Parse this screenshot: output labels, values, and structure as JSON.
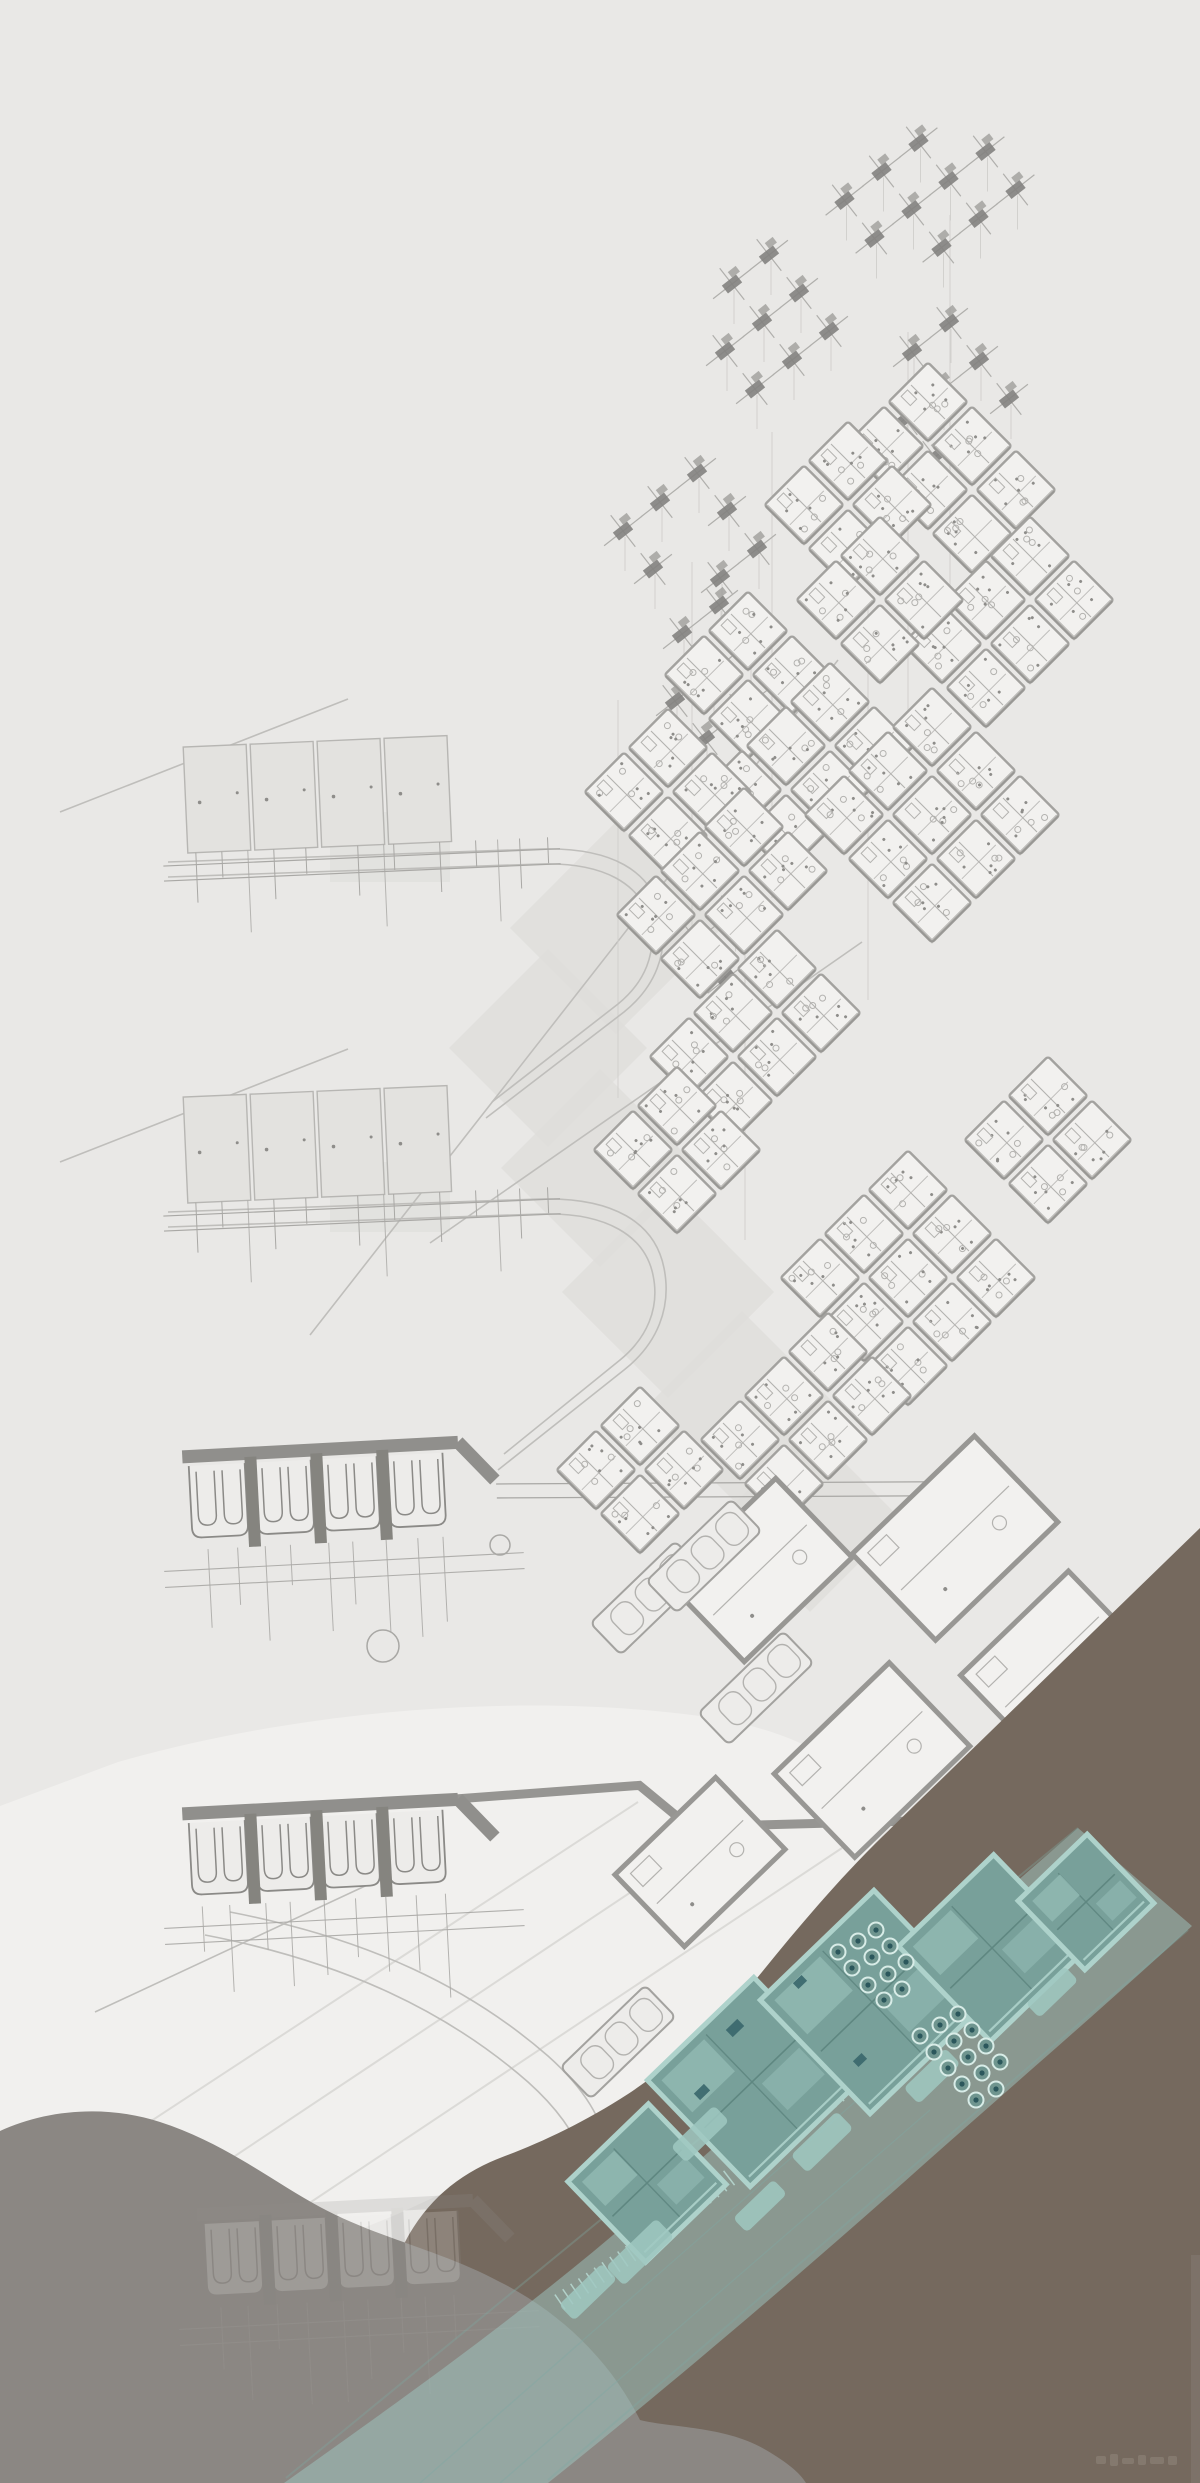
{
  "canvas": {
    "width": 1200,
    "height": 2483,
    "background": "#e9e8e6"
  },
  "palette": {
    "line_faint": "#d0cfcc",
    "line_road": "#bfbebb",
    "line_mid": "#a9a8a5",
    "panel_fill": "#e3e2df",
    "panel_stroke": "#b7b6b3",
    "tile_fill": "#f2f1ef",
    "tile_stroke": "#a3a29f",
    "tile_shadow": "#8f8e8b",
    "tile_detail": "#b3b2af",
    "tile_dot": "#8e8d8a",
    "desk_dark": "#83827f",
    "desk_mid": "#9a9996",
    "desk_leg": "#b0afac",
    "arch_bar": "#908f8c",
    "arch_line": "#8b8a87",
    "arch_fill": "#edecea",
    "arch_pillar": "#85847f",
    "patch": "#dedddb",
    "white_sheet": "#f1f0ee",
    "fold": "#dbdad7",
    "terrain_brown": "#75695e",
    "terrain_mound": "#8b8783",
    "edge_strip": "#80766d",
    "teal_band": "#9fc8c1",
    "teal_band_edge": "#7fa8a2",
    "teal_floor": "#78a09a",
    "teal_wall": "#aed2cb",
    "teal_room": "#8fb7b0",
    "teal_line": "#5f8781",
    "teal_hatch": "#b9dbd4",
    "teal_dark": "#38666b",
    "tree_ring": "#d8ece7",
    "tree_fill": "#6f958f",
    "tree_dot": "#2b575c",
    "loose_wall": "#989794",
    "watermark": "#93897f"
  },
  "terrain": {
    "white_sheet_path": "M 118 1762 C 300 1710 520 1692 700 1716 C 802 1730 864 1770 882 1822 C 866 1874 830 1926 780 1976 C 730 2026 668 2073 600 2113 C 540 2147 470 2181 400 2213 C 330 2243 250 2269 180 2273 C 118 2276 68 2256 38 2230 L 0 2208 L 0 1806 Z",
    "brown_path": "M 1200 1528 L 883 1836 C 840 1878 800 1925 762 1972 C 724 2019 676 2062 628 2094 C 585 2122 540 2143 505 2156 C 462 2172 428 2198 405 2242 C 388 2275 378 2320 374 2365 L 370 2483 L 1200 2483 Z",
    "mound_path": "M 0 2131 C 45 2110 105 2104 160 2122 C 225 2143 270 2180 320 2207 C 380 2239 440 2250 500 2282 C 560 2312 610 2360 640 2420 C 672 2428 726 2426 766 2450 C 788 2463 800 2473 806 2483 L 0 2483 Z",
    "edge_strip": [
      1191,
      2255,
      9,
      228
    ]
  },
  "fold_lines": [
    [
      242,
      2248,
      842,
      1848
    ],
    [
      142,
      2218,
      742,
      1818
    ],
    [
      58,
      2182,
      638,
      1802
    ]
  ],
  "diagonals": [
    [
      310,
      1335,
      838,
      660
    ],
    [
      430,
      1243,
      862,
      942
    ],
    [
      60,
      812,
      348,
      699
    ],
    [
      60,
      1162,
      348,
      1049
    ],
    [
      95,
      2012,
      378,
      1880
    ]
  ],
  "verticals": [
    [
      772,
      432,
      898
    ],
    [
      908,
      332,
      792
    ],
    [
      950,
      215,
      602
    ],
    [
      692,
      562,
      942
    ],
    [
      618,
      700,
      1098
    ],
    [
      868,
      598,
      1000
    ],
    [
      745,
      880,
      1240
    ]
  ],
  "roads": [
    "M 168 862 L 540 849 C 612 847 652 871 661 915 C 669 953 655 987 624 1012 L 486 1118",
    "M 168 877 L 540 864 C 604 862 641 884 650 921 C 657 953 645 982 618 1004 L 492 1102",
    "M 168 1212 L 540 1199 C 614 1197 655 1223 664 1268 C 672 1308 657 1344 624 1370 L 498 1470",
    "M 168 1227 L 540 1214 C 607 1212 645 1236 653 1275 C 660 1308 647 1338 620 1360 L 504 1454",
    "M 205 1935 C 345 1962 448 2012 528 2082 C 566 2116 585 2149 590 2182",
    "M 230 1912 C 370 1939 470 1988 548 2056 C 585 2089 603 2120 608 2152"
  ],
  "patches": [
    [
      616,
      928,
      150
    ],
    [
      548,
      1048,
      140
    ],
    [
      600,
      1168,
      140
    ],
    [
      668,
      1292,
      150
    ],
    [
      742,
      1410,
      140
    ],
    [
      810,
      1520,
      130
    ]
  ],
  "patch_rects": [
    [
      330,
      812,
      120,
      70
    ],
    [
      330,
      1162,
      120,
      70
    ]
  ],
  "panel_rows": [
    [
      188,
      747
    ],
    [
      188,
      1097
    ]
  ],
  "arch_rows": [
    {
      "x": 190,
      "y": 1450,
      "ext": "short"
    },
    {
      "x": 190,
      "y": 1807,
      "ext": "long"
    }
  ],
  "ghost_row": {
    "x": 205,
    "y": 2208,
    "opacity": 0.2
  },
  "desk_clusters": [
    [
      930,
      195,
      4,
      3
    ],
    [
      762,
      322,
      3,
      3
    ],
    [
      942,
      390,
      3,
      3
    ],
    [
      690,
      540,
      3,
      3
    ],
    [
      712,
      672,
      3,
      3
    ],
    [
      730,
      945,
      2,
      2
    ]
  ],
  "plan_clusters": [
    [
      950,
      468,
      2,
      3
    ],
    [
      848,
      505,
      2,
      2
    ],
    [
      1008,
      622,
      3,
      2
    ],
    [
      880,
      600,
      2,
      2
    ],
    [
      748,
      675,
      2,
      2
    ],
    [
      808,
      768,
      3,
      2
    ],
    [
      932,
      815,
      3,
      3
    ],
    [
      668,
      792,
      2,
      2
    ],
    [
      722,
      893,
      3,
      2
    ],
    [
      755,
      1035,
      3,
      2
    ],
    [
      677,
      1150,
      2,
      2
    ],
    [
      1048,
      1140,
      2,
      2
    ],
    [
      908,
      1278,
      3,
      3
    ],
    [
      806,
      1418,
      3,
      2
    ],
    [
      640,
      1470,
      2,
      2
    ]
  ],
  "loose_rooms": [
    [
      760,
      1570,
      150,
      110
    ],
    [
      955,
      1538,
      170,
      120
    ],
    [
      1052,
      1662,
      150,
      108
    ],
    [
      872,
      1760,
      160,
      116
    ],
    [
      700,
      1862,
      140,
      100
    ],
    [
      1002,
      1856,
      150,
      108
    ]
  ],
  "parking_strips": [
    [
      648,
      1598
    ],
    [
      704,
      1556
    ],
    [
      756,
      1688
    ],
    [
      618,
      2042
    ]
  ],
  "junction_circles": [
    [
      383,
      1646,
      16
    ],
    [
      500,
      1545,
      10
    ]
  ],
  "teal": {
    "band_path": "M 1078 1828 C 938 1950 778 2092 640 2212 C 520 2316 398 2402 284 2483 L 548 2483 C 662 2392 792 2282 922 2166 C 1012 2086 1112 2000 1192 1926 Z",
    "band_edges": [
      [
        1078,
        1828,
        286,
        2478
      ],
      [
        1188,
        1930,
        548,
        2480
      ]
    ],
    "band_arcs": [
      "M 420 2483 C 560 2360 720 2220 880 2080",
      "M 500 2483 C 640 2362 790 2230 930 2110"
    ],
    "blocks": [
      [
        647,
        2183,
        112
      ],
      [
        752,
        2082,
        148
      ],
      [
        872,
        2002,
        158
      ],
      [
        992,
        1948,
        132
      ],
      [
        1086,
        1902,
        96
      ]
    ],
    "pads": [
      [
        640,
        2252,
        70,
        26
      ],
      [
        588,
        2292,
        60,
        22
      ],
      [
        822,
        2142,
        64,
        24
      ],
      [
        932,
        2076,
        58,
        22
      ],
      [
        1052,
        1992,
        54,
        20
      ],
      [
        760,
        2206,
        56,
        20
      ],
      [
        700,
        2134,
        60,
        22
      ]
    ],
    "darks": [
      [
        735,
        2028,
        16,
        10
      ],
      [
        800,
        1982,
        12,
        8
      ],
      [
        702,
        2092,
        14,
        9
      ],
      [
        860,
        2060,
        12,
        8
      ]
    ],
    "trees": [
      [
        838,
        1952
      ],
      [
        858,
        1941
      ],
      [
        876,
        1930
      ],
      [
        852,
        1968
      ],
      [
        872,
        1957
      ],
      [
        890,
        1946
      ],
      [
        868,
        1985
      ],
      [
        888,
        1974
      ],
      [
        906,
        1962
      ],
      [
        884,
        2000
      ],
      [
        902,
        1989
      ],
      [
        920,
        2036
      ],
      [
        940,
        2025
      ],
      [
        958,
        2014
      ],
      [
        934,
        2052
      ],
      [
        954,
        2041
      ],
      [
        972,
        2030
      ],
      [
        948,
        2068
      ],
      [
        968,
        2057
      ],
      [
        986,
        2046
      ],
      [
        962,
        2084
      ],
      [
        982,
        2073
      ],
      [
        1000,
        2062
      ],
      [
        976,
        2100
      ],
      [
        996,
        2089
      ]
    ],
    "hatches": [
      [
        690,
        2208,
        862,
        2076,
        22
      ],
      [
        880,
        2062,
        1032,
        1956,
        19
      ],
      [
        560,
        2302,
        662,
        2232,
        13
      ],
      [
        1040,
        1950,
        1120,
        1896,
        10
      ]
    ]
  },
  "watermark": {
    "x": 1096,
    "y": 2452,
    "marks": [
      [
        0,
        4,
        10,
        8
      ],
      [
        14,
        2,
        8,
        12
      ],
      [
        26,
        6,
        12,
        6
      ],
      [
        42,
        3,
        8,
        10
      ],
      [
        54,
        5,
        14,
        7
      ],
      [
        72,
        4,
        9,
        9
      ]
    ]
  }
}
